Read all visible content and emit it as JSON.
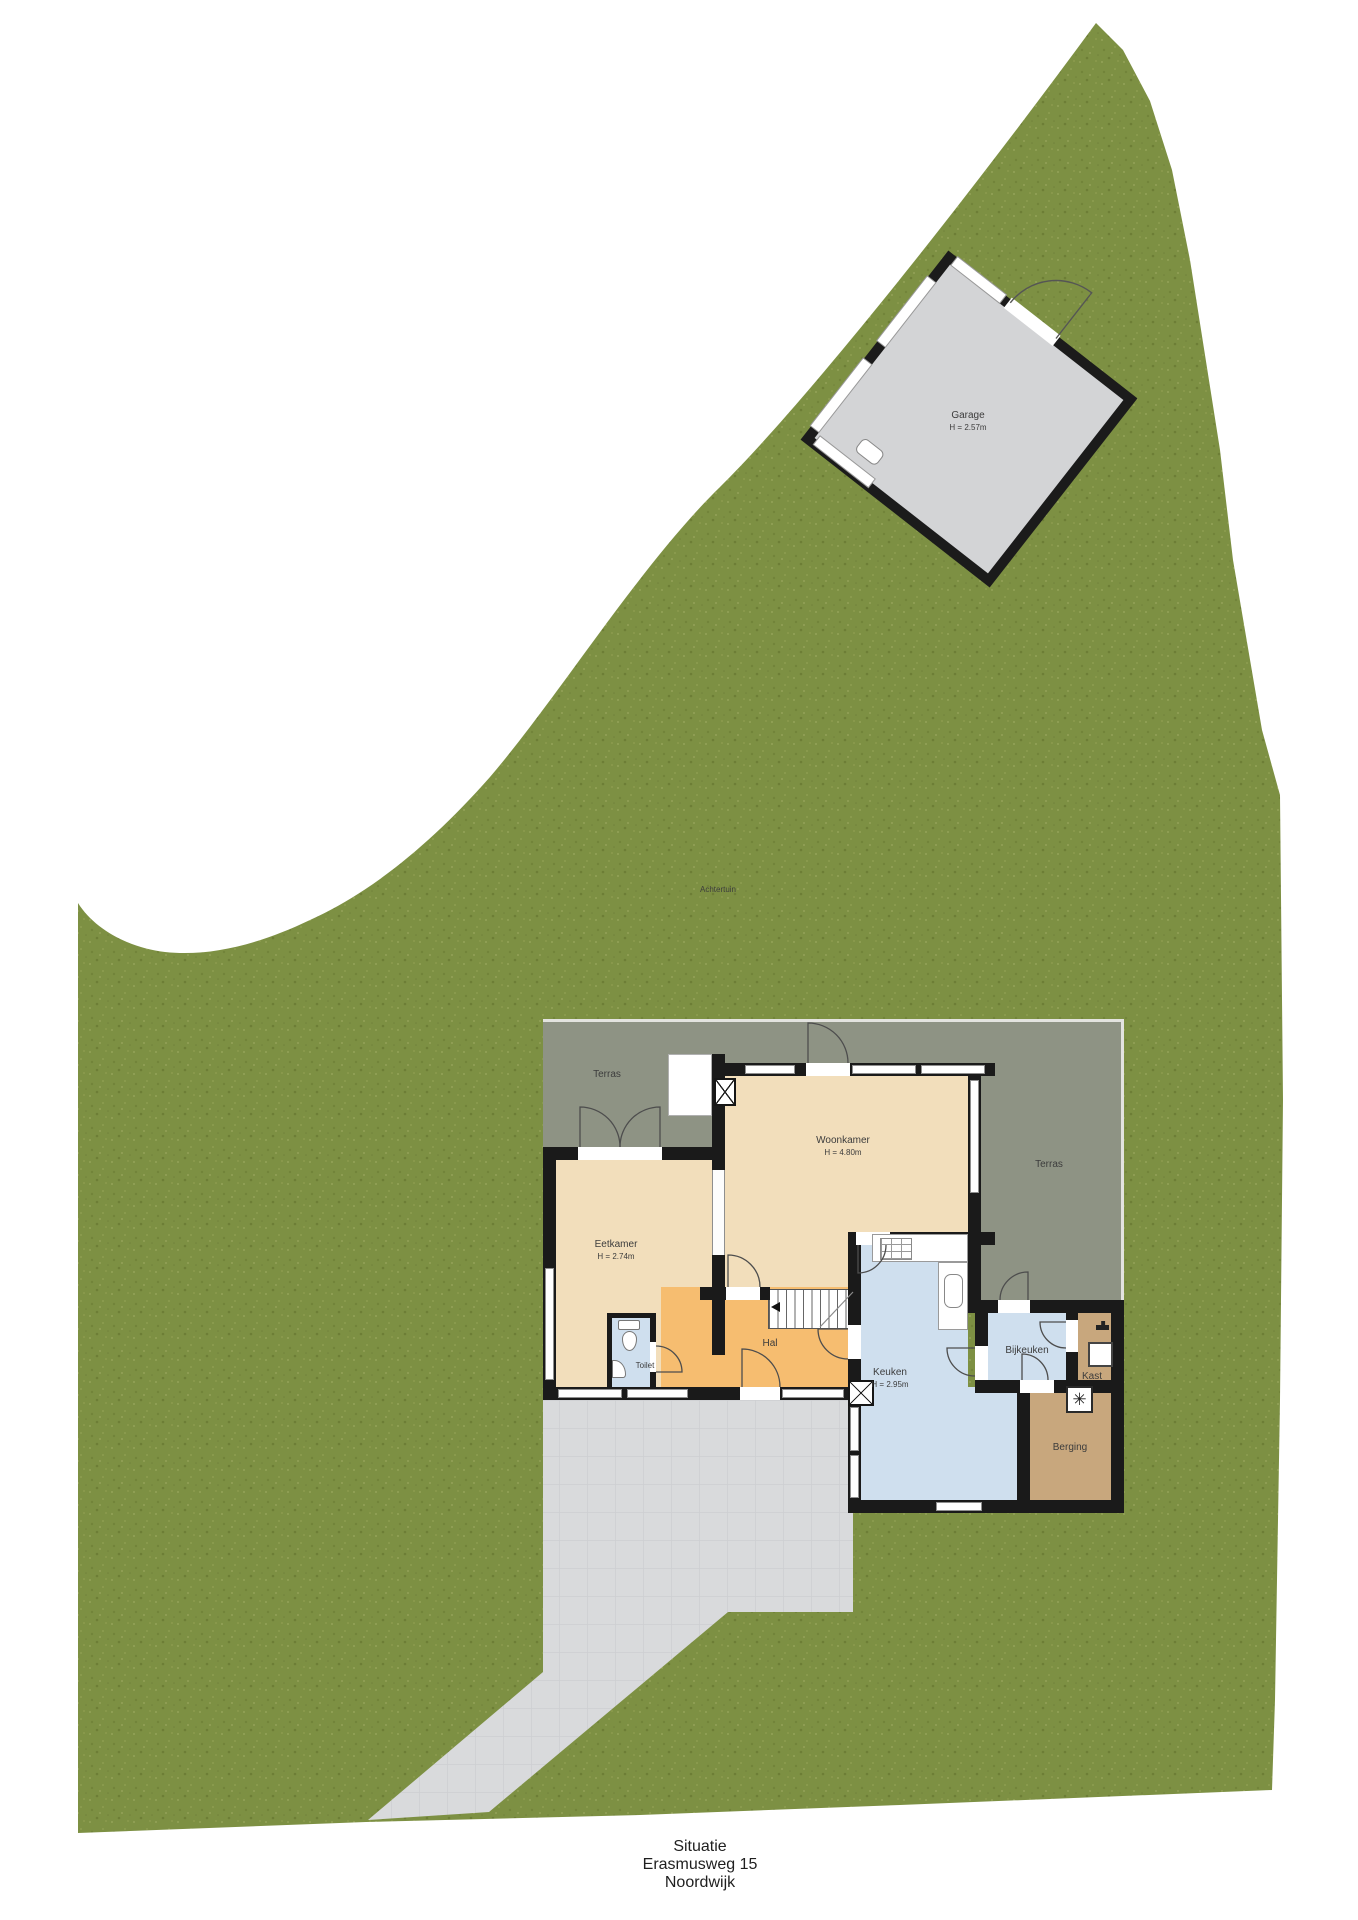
{
  "title": {
    "line1": "Situatie",
    "line2": "Erasmusweg 15",
    "line3": "Noordwijk"
  },
  "site": {
    "backyard_label": "Achtertuin"
  },
  "garage": {
    "label": "Garage",
    "height": "H = 2.57m"
  },
  "rooms": [
    {
      "id": "terras-left",
      "label": "Terras"
    },
    {
      "id": "woonkamer",
      "label": "Woonkamer",
      "height": "H = 4.80m"
    },
    {
      "id": "terras-right",
      "label": "Terras"
    },
    {
      "id": "eetkamer",
      "label": "Eetkamer",
      "height": "H = 2.74m"
    },
    {
      "id": "toilet",
      "label": "Toilet"
    },
    {
      "id": "hal",
      "label": "Hal"
    },
    {
      "id": "keuken",
      "label": "Keuken",
      "height": "H = 2.95m"
    },
    {
      "id": "bijkeuken",
      "label": "Bijkeuken"
    },
    {
      "id": "kast",
      "label": "Kast"
    },
    {
      "id": "berging",
      "label": "Berging"
    }
  ],
  "colors": {
    "grass": "#7d9043",
    "terras": "#8e9384",
    "living": "#f2debb",
    "hal": "#f6bd70",
    "wet": "#cfdfee",
    "storage": "#c8a77d",
    "driveway": "#d9dadc",
    "garage": "#d3d4d6",
    "wall": "#1a1a1a"
  }
}
